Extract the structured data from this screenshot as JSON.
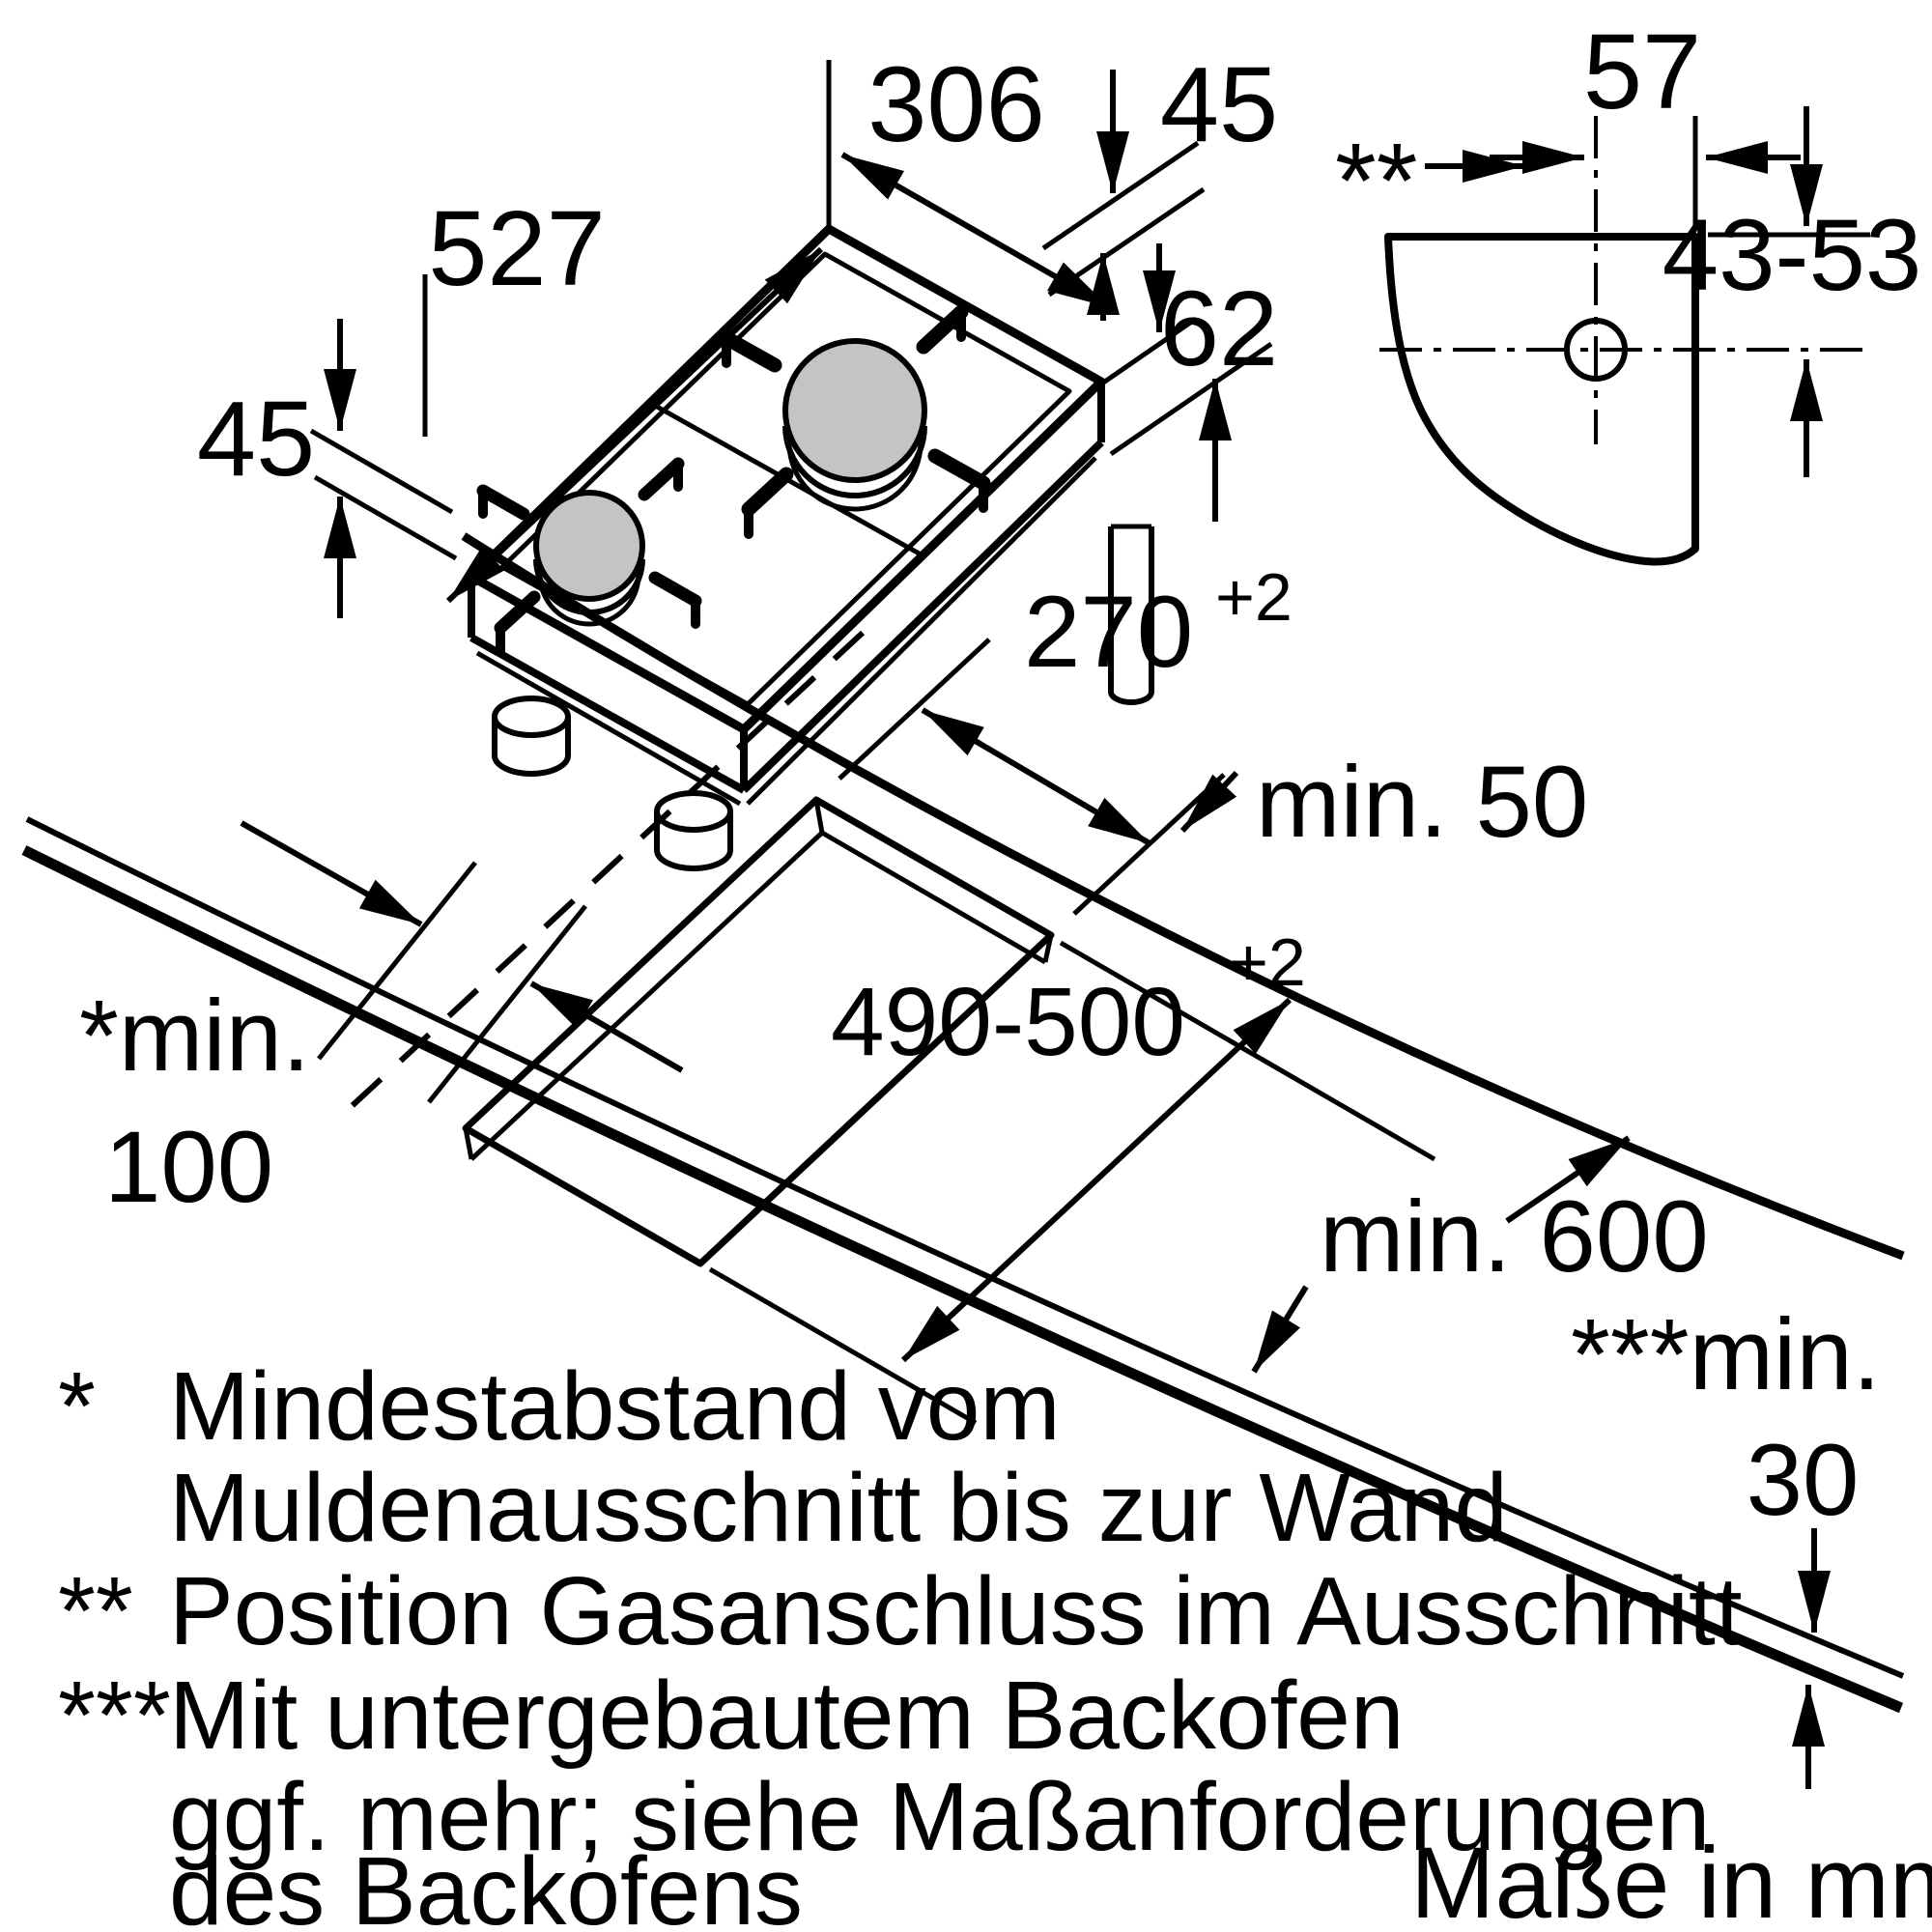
{
  "diagram": {
    "hob": {
      "width": "306",
      "height_top": "45",
      "depth": "527",
      "height_left": "45",
      "height_body": "62"
    },
    "gas_detail": {
      "offset_horizontal": "57",
      "marker": "**",
      "offset_vertical": "43-53"
    },
    "worktop": {
      "cutout_width": "270",
      "cutout_width_tol": "+2",
      "back_clearance": "min. 50",
      "cutout_depth": "490-500",
      "cutout_depth_tol": "+2",
      "wall_label": "*min.",
      "wall_value": "100",
      "depth_label": "min. 600",
      "oven_label": "***min.",
      "oven_value": "30"
    },
    "footnotes": [
      {
        "marker": "*",
        "text": "Mindestabstand vom"
      },
      {
        "marker": "",
        "text": "Muldenausschnitt bis zur Wand"
      },
      {
        "marker": "**",
        "text": "Position Gasanschluss im Ausschnitt"
      },
      {
        "marker": "***",
        "text": "Mit untergebautem Backofen"
      },
      {
        "marker": "",
        "text": "ggf. mehr; siehe Maßanforderungen"
      },
      {
        "marker": "",
        "text": "des Backofens"
      }
    ],
    "units_note": "Maße in mm",
    "colors": {
      "line": "#000000",
      "burner_fill": "#c4c4c4",
      "background": "#ffffff"
    }
  }
}
